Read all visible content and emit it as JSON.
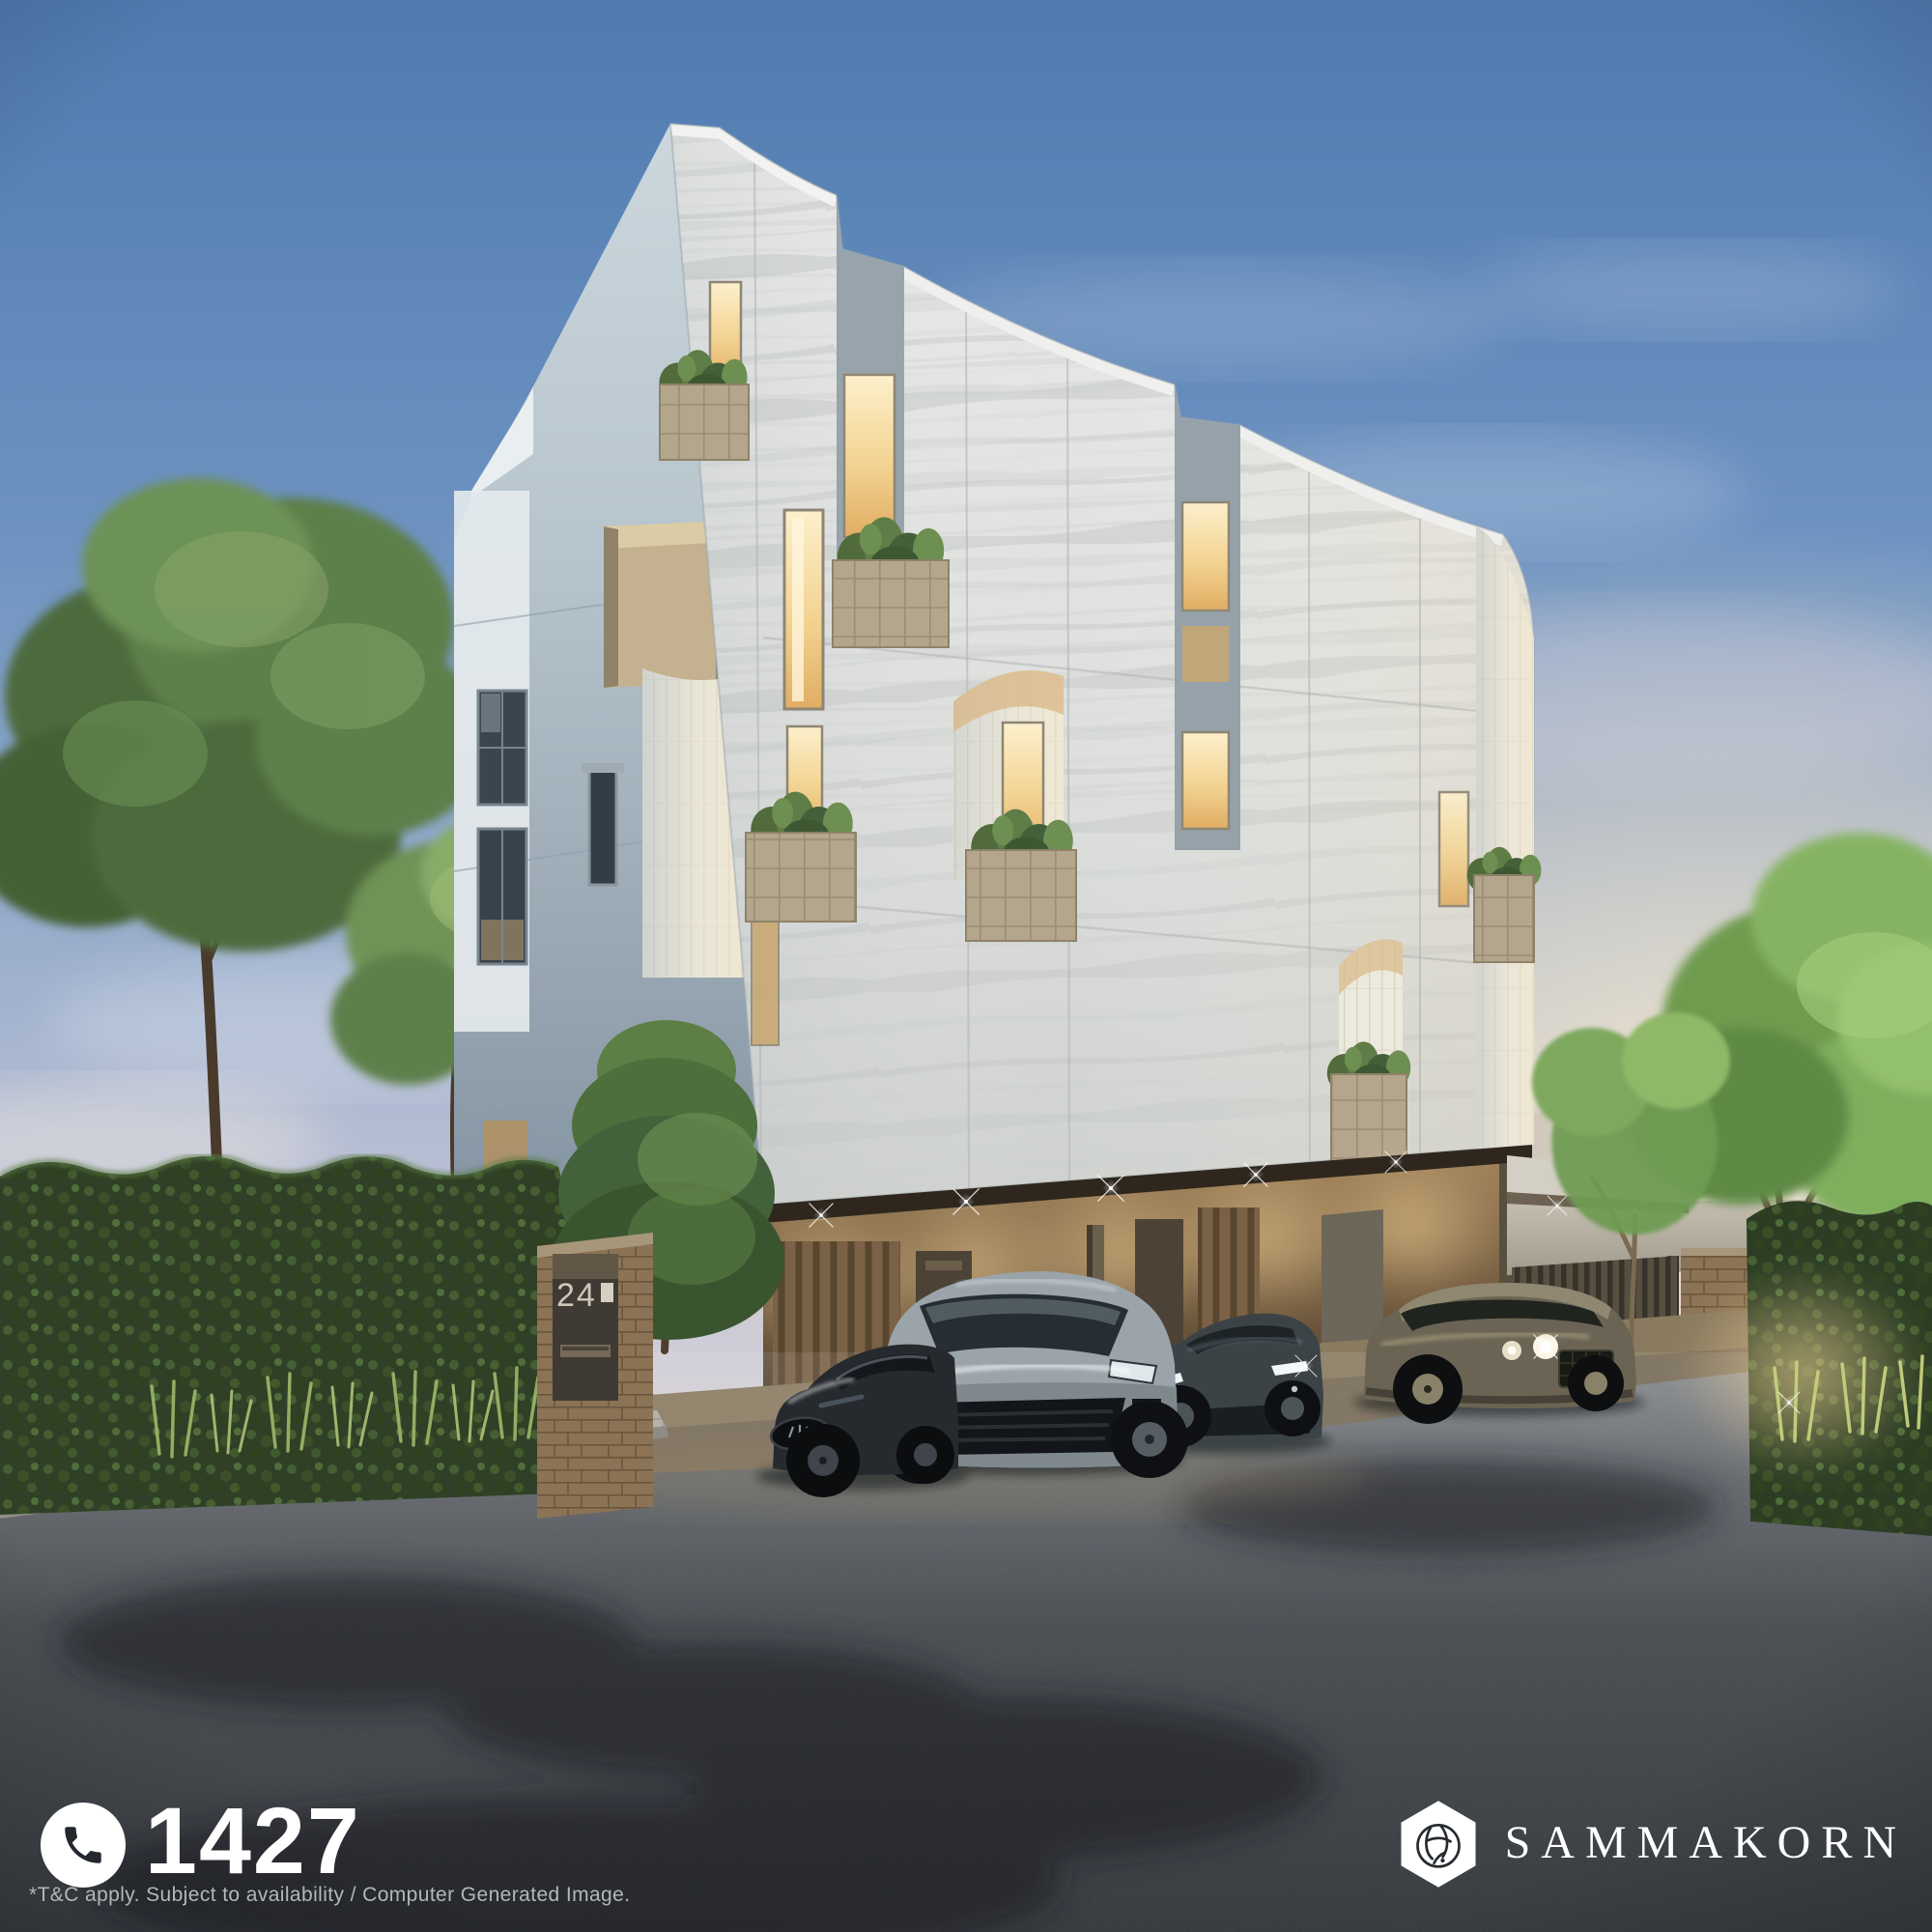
{
  "overlay": {
    "phone": {
      "icon": "phone-icon",
      "number": "1427"
    },
    "disclaimer": "*T&C apply. Subject to availability / Computer Generated Image.",
    "brand": {
      "logo_icon": "sammakorn-hexagon-monogram-logo",
      "wordmark": "SAMMAKORN"
    }
  },
  "scene": {
    "house_number": "24"
  },
  "colors": {
    "sky_top": "#4f7bb0",
    "sky_horizon": "#f7f0e0",
    "sunset_glow": "#ffe9c6",
    "travertine_facade": "#dddfdd",
    "stucco_facade": "#b6c4cd",
    "warm_window_light": "#f3d392",
    "carport_wood": "#7b6146",
    "planter_tile": "#b3a68d",
    "hedge_green": "#3c5429",
    "tree_green": "#6d8f52",
    "asphalt": "#33373c",
    "phone_text": "#ffffff",
    "disclaimer_text": "#b3b7bc",
    "brand_text": "#ffffff"
  }
}
